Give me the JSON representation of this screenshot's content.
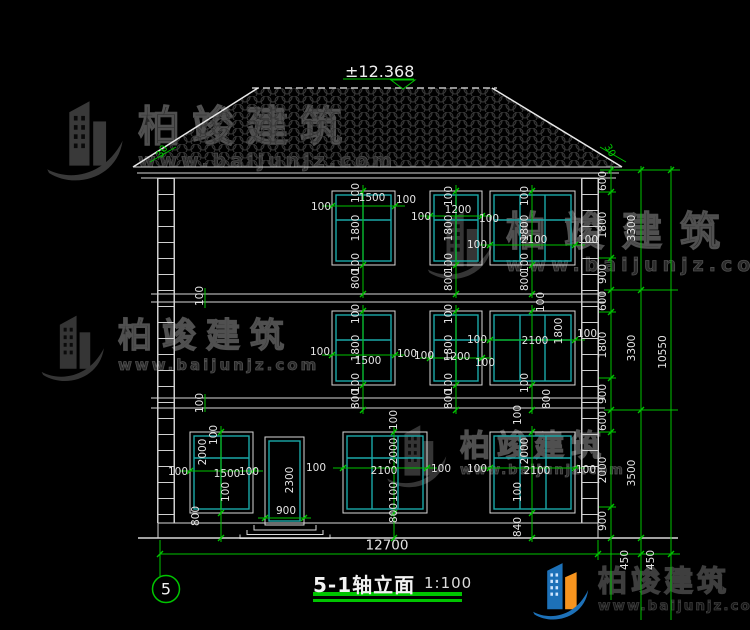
{
  "drawing": {
    "elevation_mark": "±12.368",
    "title": "5-1轴立面",
    "scale_label": "1:100",
    "axis_label": "5",
    "total_width": "12700",
    "total_height": "10550",
    "floor_height_chain": [
      "3300",
      "3300",
      "3500",
      "450"
    ],
    "roof_slope": "30",
    "floors": [
      {
        "level": "third",
        "window_widths": [
          "1500",
          "1200",
          "2100"
        ],
        "window_height": "1800",
        "sill": "800"
      },
      {
        "level": "second",
        "window_widths": [
          "1500",
          "1200",
          "2100"
        ],
        "window_height": "1800",
        "sill": "800"
      },
      {
        "level": "first",
        "window_widths": [
          "1500",
          "2100",
          "2100"
        ],
        "window_height": "2000",
        "door": "900x2300"
      }
    ]
  },
  "watermark": {
    "name": "柏竣建筑",
    "url": "www.baijunjz.com"
  },
  "brand": {
    "name": "柏竣建筑",
    "url": "www.baijunjz.com"
  },
  "annotations": [
    {
      "t": "600",
      "x": 603,
      "y": 181,
      "r": -90
    },
    {
      "t": "1800",
      "x": 603,
      "y": 225,
      "r": -90
    },
    {
      "t": "900",
      "x": 603,
      "y": 274,
      "r": -90
    },
    {
      "t": "600",
      "x": 603,
      "y": 301,
      "r": -90
    },
    {
      "t": "1800",
      "x": 603,
      "y": 345,
      "r": -90
    },
    {
      "t": "900",
      "x": 603,
      "y": 394,
      "r": -90
    },
    {
      "t": "600",
      "x": 603,
      "y": 421,
      "r": -90
    },
    {
      "t": "2000",
      "x": 603,
      "y": 470,
      "r": -90
    },
    {
      "t": "900",
      "x": 603,
      "y": 521,
      "r": -90
    },
    {
      "t": "450",
      "x": 625,
      "y": 560,
      "r": -90
    },
    {
      "t": "450",
      "x": 651,
      "y": 560,
      "r": -90
    },
    {
      "t": "3300",
      "x": 632,
      "y": 228,
      "r": -90
    },
    {
      "t": "3300",
      "x": 632,
      "y": 348,
      "r": -90
    },
    {
      "t": "3500",
      "x": 632,
      "y": 473,
      "r": -90
    },
    {
      "t": "10550",
      "x": 663,
      "y": 352,
      "r": -90
    },
    {
      "t": "30",
      "x": 163,
      "y": 152,
      "r": -60,
      "c": "grn"
    },
    {
      "t": "30",
      "x": 609,
      "y": 151,
      "r": 60,
      "c": "grn"
    },
    {
      "t": "100",
      "x": 200,
      "y": 296,
      "r": -90
    },
    {
      "t": "100",
      "x": 200,
      "y": 403,
      "r": -90
    },
    {
      "t": "100",
      "x": 356,
      "y": 193,
      "r": -90
    },
    {
      "t": "1800",
      "x": 356,
      "y": 228,
      "r": -90
    },
    {
      "t": "100",
      "x": 356,
      "y": 263,
      "r": -90
    },
    {
      "t": "800",
      "x": 356,
      "y": 279,
      "r": -90
    },
    {
      "t": "100",
      "x": 321,
      "y": 207
    },
    {
      "t": "1500",
      "x": 372,
      "y": 198
    },
    {
      "t": "100",
      "x": 406,
      "y": 200
    },
    {
      "t": "100",
      "x": 449,
      "y": 196,
      "r": -90
    },
    {
      "t": "1800",
      "x": 449,
      "y": 228,
      "r": -90
    },
    {
      "t": "100",
      "x": 449,
      "y": 263,
      "r": -90
    },
    {
      "t": "800",
      "x": 449,
      "y": 281,
      "r": -90
    },
    {
      "t": "100",
      "x": 421,
      "y": 217
    },
    {
      "t": "1200",
      "x": 458,
      "y": 210
    },
    {
      "t": "100",
      "x": 489,
      "y": 219
    },
    {
      "t": "100",
      "x": 525,
      "y": 196,
      "r": -90
    },
    {
      "t": "1800",
      "x": 525,
      "y": 228,
      "r": -90
    },
    {
      "t": "100",
      "x": 525,
      "y": 263,
      "r": -90
    },
    {
      "t": "800",
      "x": 525,
      "y": 281,
      "r": -90
    },
    {
      "t": "100",
      "x": 477,
      "y": 245
    },
    {
      "t": "2100",
      "x": 534,
      "y": 240
    },
    {
      "t": "100",
      "x": 588,
      "y": 240
    },
    {
      "t": "100",
      "x": 356,
      "y": 314,
      "r": -90
    },
    {
      "t": "1800",
      "x": 356,
      "y": 348,
      "r": -90
    },
    {
      "t": "100",
      "x": 356,
      "y": 383,
      "r": -90
    },
    {
      "t": "800",
      "x": 356,
      "y": 399,
      "r": -90
    },
    {
      "t": "100",
      "x": 320,
      "y": 352
    },
    {
      "t": "1500",
      "x": 368,
      "y": 361
    },
    {
      "t": "100",
      "x": 407,
      "y": 354
    },
    {
      "t": "100",
      "x": 449,
      "y": 314,
      "r": -90
    },
    {
      "t": "1800",
      "x": 449,
      "y": 348,
      "r": -90
    },
    {
      "t": "100",
      "x": 449,
      "y": 383,
      "r": -90
    },
    {
      "t": "800",
      "x": 449,
      "y": 399,
      "r": -90
    },
    {
      "t": "100",
      "x": 424,
      "y": 356
    },
    {
      "t": "1200",
      "x": 457,
      "y": 357
    },
    {
      "t": "100",
      "x": 485,
      "y": 363
    },
    {
      "t": "100",
      "x": 541,
      "y": 302,
      "r": -90
    },
    {
      "t": "1800",
      "x": 559,
      "y": 331,
      "r": -90
    },
    {
      "t": "100",
      "x": 525,
      "y": 383,
      "r": -90
    },
    {
      "t": "800",
      "x": 547,
      "y": 399,
      "r": -90
    },
    {
      "t": "100",
      "x": 477,
      "y": 340
    },
    {
      "t": "2100",
      "x": 535,
      "y": 341
    },
    {
      "t": "100",
      "x": 587,
      "y": 334
    },
    {
      "t": "100",
      "x": 214,
      "y": 435,
      "r": -90
    },
    {
      "t": "2000",
      "x": 203,
      "y": 452,
      "r": -90
    },
    {
      "t": "100",
      "x": 226,
      "y": 492,
      "r": -90
    },
    {
      "t": "800",
      "x": 196,
      "y": 516,
      "r": -90
    },
    {
      "t": "100",
      "x": 178,
      "y": 472
    },
    {
      "t": "1500",
      "x": 227,
      "y": 474
    },
    {
      "t": "100",
      "x": 249,
      "y": 472
    },
    {
      "t": "2300",
      "x": 290,
      "y": 480,
      "r": -90
    },
    {
      "t": "900",
      "x": 286,
      "y": 511
    },
    {
      "t": "100",
      "x": 394,
      "y": 420,
      "r": -90
    },
    {
      "t": "2000",
      "x": 394,
      "y": 451,
      "r": -90
    },
    {
      "t": "100",
      "x": 394,
      "y": 492,
      "r": -90
    },
    {
      "t": "800",
      "x": 394,
      "y": 513,
      "r": -90
    },
    {
      "t": "100",
      "x": 316,
      "y": 468
    },
    {
      "t": "2100",
      "x": 384,
      "y": 471
    },
    {
      "t": "100",
      "x": 441,
      "y": 469
    },
    {
      "t": "100",
      "x": 518,
      "y": 415,
      "r": -90
    },
    {
      "t": "2000",
      "x": 525,
      "y": 451,
      "r": -90
    },
    {
      "t": "100",
      "x": 518,
      "y": 492,
      "r": -90
    },
    {
      "t": "840",
      "x": 518,
      "y": 527,
      "r": -90
    },
    {
      "t": "100",
      "x": 477,
      "y": 469
    },
    {
      "t": "2100",
      "x": 537,
      "y": 471
    },
    {
      "t": "100",
      "x": 586,
      "y": 470
    },
    {
      "t": "12700",
      "x": 387,
      "y": 546,
      "c": "lg"
    }
  ]
}
